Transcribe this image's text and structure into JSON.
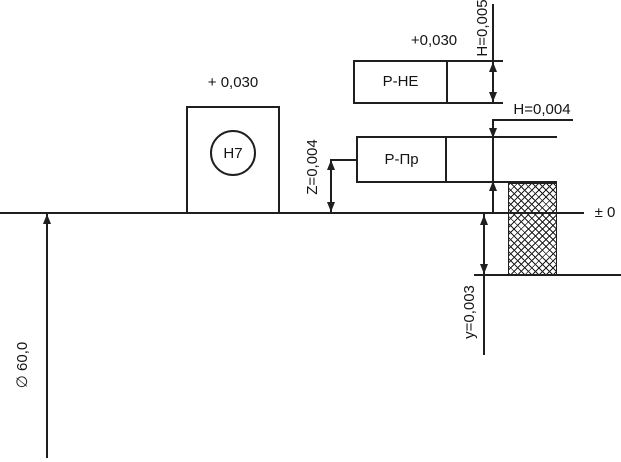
{
  "diagram": {
    "background": "#ffffff",
    "line_color": "#1f1f1f",
    "zero_line_label": "± 0",
    "diameter_label": "∅ 60,0",
    "hole": {
      "upper_deviation": "+ 0,030",
      "tolerance_grade": "H7"
    },
    "notgo_gauge": {
      "label": "Р-НЕ",
      "deviation": "+0,030",
      "tolerance": "H=0,005"
    },
    "go_gauge": {
      "label": "Р-Пр",
      "tolerance": "H=0,004",
      "offset": "Z=0,004",
      "wear_limit": "y=0,003"
    }
  }
}
